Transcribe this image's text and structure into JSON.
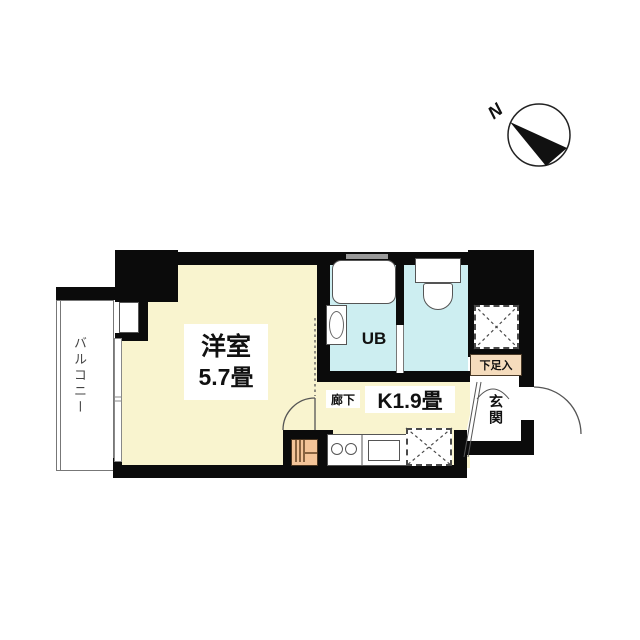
{
  "title": "apartment-floor-plan",
  "compass": {
    "north_label": "N"
  },
  "rooms": {
    "balcony": {
      "label": "バルコニー"
    },
    "main": {
      "name": "洋室",
      "size": "5.7畳"
    },
    "bath": {
      "label": "UB"
    },
    "corridor": {
      "label": "廊下"
    },
    "kitchen": {
      "label": "K1.9畳"
    },
    "entrance": {
      "label": "玄関"
    },
    "shoe_storage": {
      "label": "下足入"
    }
  },
  "fixtures": [
    "bathtub",
    "washbasin",
    "toilet",
    "kitchen-stove",
    "kitchen-sink",
    "closet-upper",
    "closet-lower",
    "utility-box",
    "entrance-door",
    "room-door",
    "shoe-cabinet-doors",
    "balcony-window"
  ],
  "colors": {
    "room_floor": "#f9f4cf",
    "wet_area_floor": "#cdeef1",
    "wall": "#0b0b0b",
    "shoe_storage_box": "#f5dcbd",
    "utility_box": "#f4c498"
  }
}
